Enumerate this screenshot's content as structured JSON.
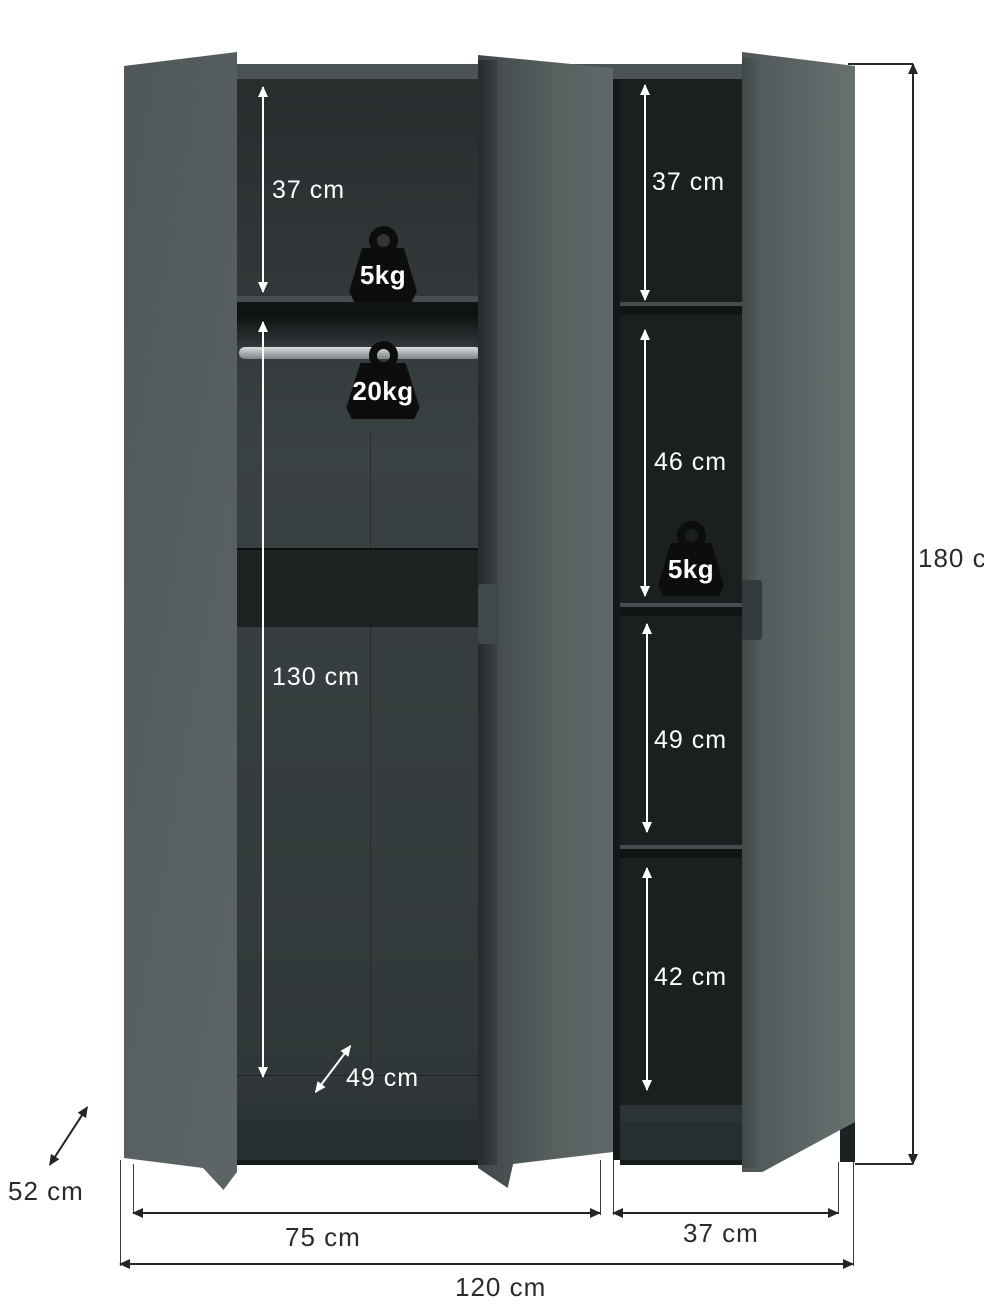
{
  "diagram": {
    "type": "wardrobe-dimension-diagram",
    "product": "three-door wardrobe shown open with internal dimensions",
    "units": "cm"
  },
  "interior_labels": {
    "left_top_shelf_height": "37 cm",
    "left_hanging_height": "130 cm",
    "left_depth": "49 cm",
    "right_shelf1_height": "37 cm",
    "right_shelf2_height": "46 cm",
    "right_shelf3_height": "49 cm",
    "right_shelf4_height": "42 cm"
  },
  "load_capacity": {
    "left_top_shelf": "5kg",
    "hanging_rod": "20kg",
    "right_shelf": "5kg"
  },
  "outer_dimensions": {
    "depth": "52 cm",
    "left_section_width": "75 cm",
    "right_section_width": "37 cm",
    "total_width": "120 cm",
    "total_height": "180 cm"
  },
  "colors": {
    "door_grey": "#5a6263",
    "interior_dark": "#191d1e",
    "weight_black": "#0d0d0d",
    "dimension_line": "#252525",
    "background": "#ffffff"
  }
}
